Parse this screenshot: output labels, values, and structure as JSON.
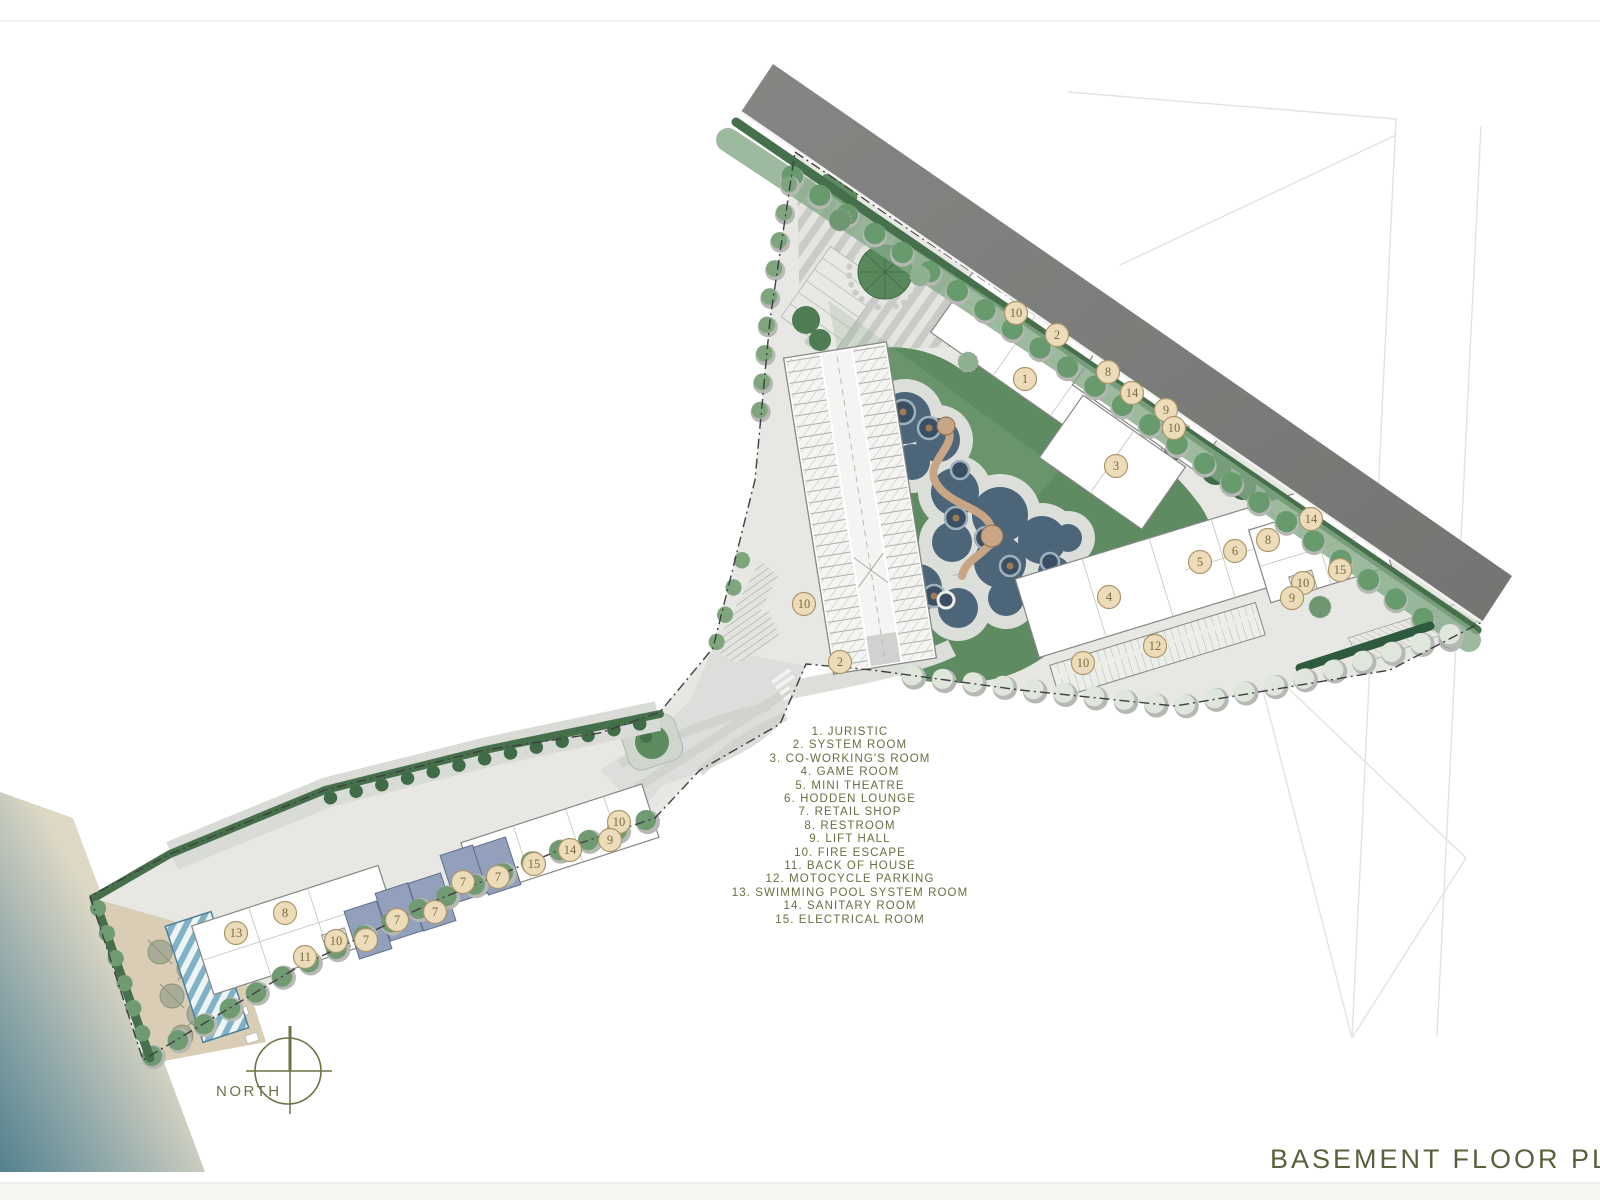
{
  "page": {
    "title": "BASEMENT FLOOR PLAN",
    "north_label": "NORTH"
  },
  "palette": {
    "text_olive": "#6b6e41",
    "title_olive": "#5d5f3c",
    "marker_fill": "#ecdcba",
    "marker_border": "#ab9668",
    "marker_text": "#7c6b3e",
    "road_gray": "#7b7d7a",
    "pool_blue": "#4c6579",
    "lawn_green": "#5e8b62",
    "hedge_green": "#46704b",
    "retail_blue": "#93a0bc",
    "sand": "#d9cdb6",
    "sea": "#4e7d92"
  },
  "legend": {
    "items": [
      {
        "num": "1",
        "label": "JURISTIC"
      },
      {
        "num": "2",
        "label": "SYSTEM ROOM"
      },
      {
        "num": "3",
        "label": "CO-WORKING'S ROOM"
      },
      {
        "num": "4",
        "label": "GAME ROOM"
      },
      {
        "num": "5",
        "label": "MINI THEATRE"
      },
      {
        "num": "6",
        "label": "HODDEN LOUNGE"
      },
      {
        "num": "7",
        "label": "RETAIL SHOP"
      },
      {
        "num": "8",
        "label": "RESTROOM"
      },
      {
        "num": "9",
        "label": "LIFT HALL"
      },
      {
        "num": "10",
        "label": "FIRE ESCAPE"
      },
      {
        "num": "11",
        "label": "BACK OF HOUSE"
      },
      {
        "num": "12",
        "label": "MOTOCYCLE PARKING"
      },
      {
        "num": "13",
        "label": "SWIMMING POOL SYSTEM ROOM"
      },
      {
        "num": "14",
        "label": "SANITARY ROOM"
      },
      {
        "num": "15",
        "label": "ELECTRICAL ROOM"
      }
    ]
  },
  "markers": [
    {
      "n": "10",
      "x": 1016,
      "y": 313
    },
    {
      "n": "2",
      "x": 1057,
      "y": 335
    },
    {
      "n": "1",
      "x": 1025,
      "y": 379
    },
    {
      "n": "8",
      "x": 1108,
      "y": 372
    },
    {
      "n": "14",
      "x": 1132,
      "y": 393
    },
    {
      "n": "9",
      "x": 1166,
      "y": 410
    },
    {
      "n": "10",
      "x": 1174,
      "y": 428
    },
    {
      "n": "3",
      "x": 1116,
      "y": 466
    },
    {
      "n": "10",
      "x": 804,
      "y": 604
    },
    {
      "n": "2",
      "x": 840,
      "y": 662
    },
    {
      "n": "14",
      "x": 1311,
      "y": 519
    },
    {
      "n": "8",
      "x": 1268,
      "y": 540
    },
    {
      "n": "6",
      "x": 1235,
      "y": 551
    },
    {
      "n": "5",
      "x": 1200,
      "y": 562
    },
    {
      "n": "15",
      "x": 1340,
      "y": 570
    },
    {
      "n": "10",
      "x": 1303,
      "y": 583
    },
    {
      "n": "9",
      "x": 1292,
      "y": 598
    },
    {
      "n": "4",
      "x": 1109,
      "y": 597
    },
    {
      "n": "12",
      "x": 1155,
      "y": 646
    },
    {
      "n": "10",
      "x": 1083,
      "y": 663
    },
    {
      "n": "10",
      "x": 619,
      "y": 822
    },
    {
      "n": "9",
      "x": 610,
      "y": 840
    },
    {
      "n": "14",
      "x": 570,
      "y": 850
    },
    {
      "n": "15",
      "x": 534,
      "y": 864
    },
    {
      "n": "7",
      "x": 498,
      "y": 877
    },
    {
      "n": "7",
      "x": 463,
      "y": 882
    },
    {
      "n": "7",
      "x": 435,
      "y": 912
    },
    {
      "n": "7",
      "x": 397,
      "y": 920
    },
    {
      "n": "7",
      "x": 366,
      "y": 940
    },
    {
      "n": "8",
      "x": 285,
      "y": 913
    },
    {
      "n": "13",
      "x": 236,
      "y": 933
    },
    {
      "n": "10",
      "x": 336,
      "y": 941
    },
    {
      "n": "11",
      "x": 305,
      "y": 957
    }
  ]
}
